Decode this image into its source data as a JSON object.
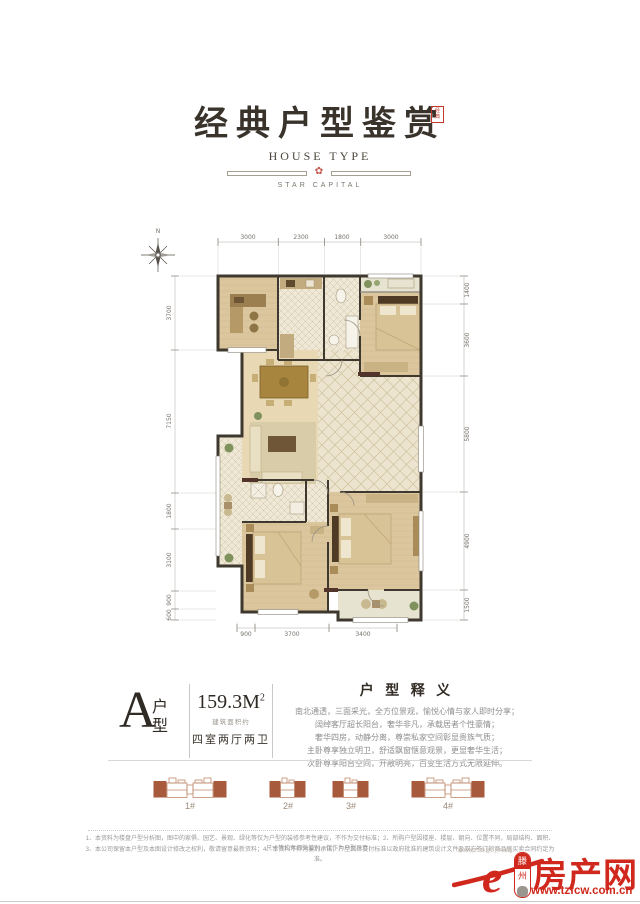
{
  "header": {
    "title": "经典户型鉴赏",
    "seal_line1": "经",
    "seal_line2": "典",
    "subtitle": "HOUSE  TYPE",
    "brand": "STAR CAPITAL"
  },
  "floorplan": {
    "compass_north": "N",
    "dims_top": [
      "3000",
      "2300",
      "1800",
      "3000"
    ],
    "dims_left": [
      "3700",
      "7150",
      "1800",
      "3100",
      "900",
      "600"
    ],
    "dims_right": [
      "1400",
      "3600",
      "5800",
      "4900",
      "1500"
    ],
    "dims_bottom": [
      "900",
      "3700",
      "3400"
    ]
  },
  "unit": {
    "letter": "A",
    "type_char1": "户",
    "type_char2": "型",
    "area_value": "159.3M",
    "area_sup": "2",
    "area_note": "建筑面积约",
    "layout": "四室两厅两卫"
  },
  "interpretation": {
    "title": "户 型 释 义",
    "lines": [
      "南北通透，三面采光，全方位景观，愉悦心情与家人即时分享；",
      "阔绰客厅超长阳台，奢华非凡，承载居者个性豪情；",
      "奢华四房，动静分离，尊崇私家空间彰显贵族气质；",
      "主卧尊享独立明卫，舒适飘窗惬意观景，更显奢华生活；",
      "次卧尊享阳台空间，开敞明亮，百变生活方式无限延伸。"
    ]
  },
  "buildings": {
    "items": [
      {
        "label": "1#"
      },
      {
        "label": "2#"
      },
      {
        "label": "3#"
      },
      {
        "label": "4#"
      }
    ]
  },
  "footer": {
    "disclaimer_line1": "1、本资料为楼盘户型分析图，图中的家俱、园艺、景观、绿化等仅为户型的装修参考性建议，不作为交付标准；2、所购户型因楼座、楼层、朝向、位置不同，局部结构、面积、尺寸等均有细微差别，仅作为户型示意；",
    "disclaimer_line2": "3、本公司保留本户型及本图设计修改之权利，敬请留意最新资料；4、本资料不作为要约承诺，户型具体交付标准以政府批准的建筑设计文件及双方签订的商品房买卖合同约定为准。",
    "logo": {
      "tagline": "滕州房产专业门户网站",
      "e_char": "e",
      "city_char1": "滕",
      "city_char2": "州",
      "name": "房产网",
      "url": "www.tzfcw.com.cn"
    }
  },
  "colors": {
    "accent_red": "#d0281c",
    "seal_red": "#c0392b",
    "title_ink": "#39332c",
    "brick": "#a85a3c"
  }
}
